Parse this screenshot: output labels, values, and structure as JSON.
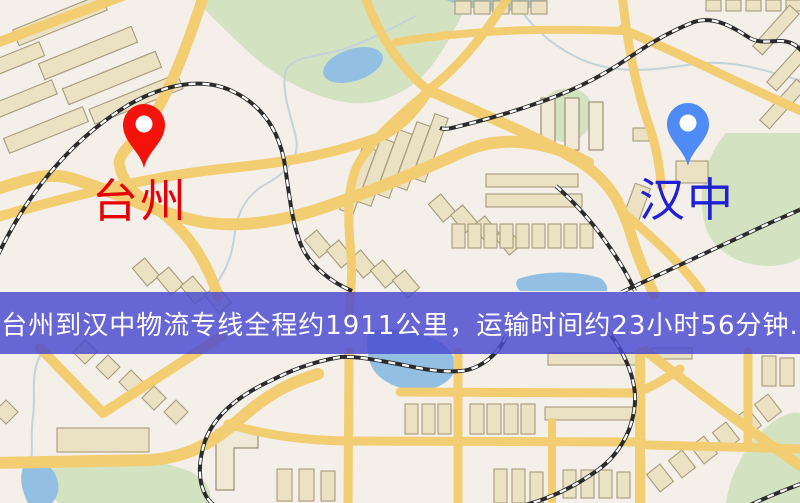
{
  "banner": {
    "text": "台州到汉中物流专线全程约1911公里，运输时间约23小时56分钟.",
    "bg_color": "#4848d0",
    "text_color": "#ffffff"
  },
  "markers": {
    "origin": {
      "label": "台州",
      "pin_color": "#f3130b",
      "label_color": "#e60006"
    },
    "destination": {
      "label": "汉中",
      "pin_color": "#4e8bf5",
      "label_color": "#1f1fd6"
    }
  },
  "map": {
    "background_color": "#f4efe8",
    "road_color": "#f3cd72",
    "park_color": "#d3e2c0",
    "water_color": "#93c0e2",
    "building_color": "#ebe2c4",
    "railway_color": "#2b2b2b"
  }
}
